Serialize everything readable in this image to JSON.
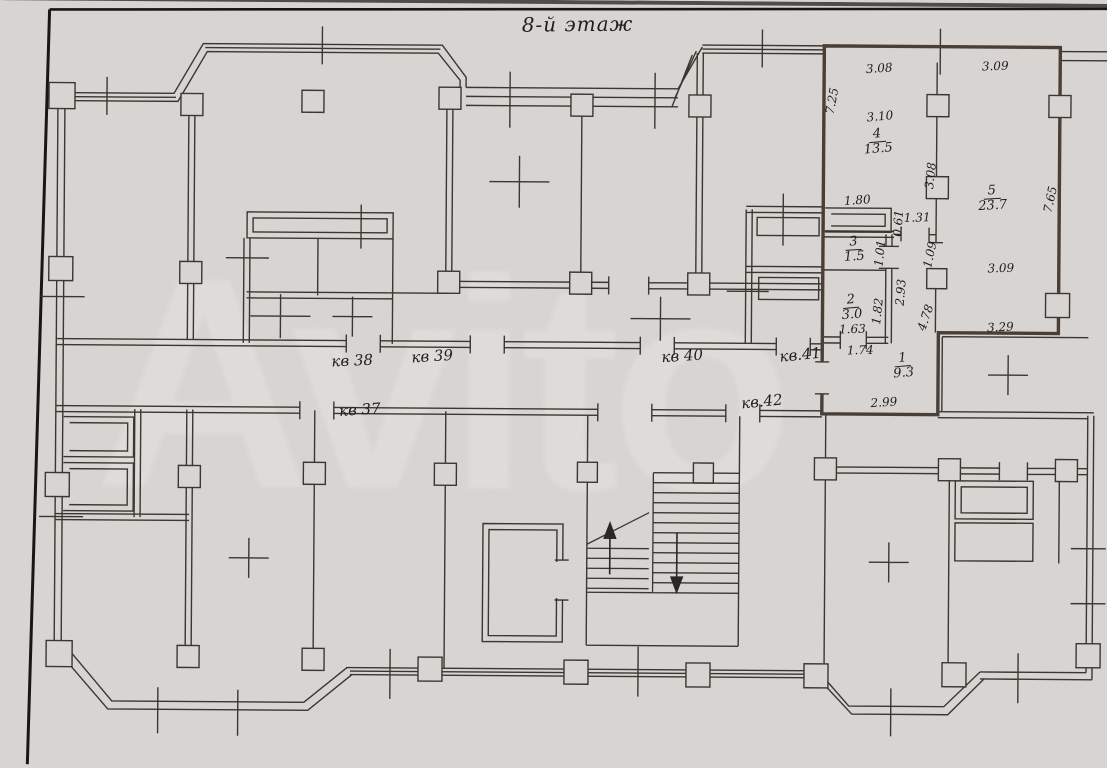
{
  "title": "8-й этаж",
  "watermark": "Avito",
  "apartments": [
    {
      "label": "кв 38"
    },
    {
      "label": "кв 39"
    },
    {
      "label": "кв 40"
    },
    {
      "label": "кв.41"
    },
    {
      "label": "кв 37"
    },
    {
      "label": "кв.42"
    }
  ],
  "flat": {
    "accent_color": "#4a3e35",
    "rooms": [
      {
        "number": "1",
        "area": "9.3"
      },
      {
        "number": "2",
        "area": "3.0"
      },
      {
        "number": "3",
        "area": "1.5"
      },
      {
        "number": "4",
        "area": "13.5"
      },
      {
        "number": "5",
        "area": "23.7"
      }
    ],
    "dims": {
      "room4_top_width": "3.08",
      "room5_top_width": "3.09",
      "left_height": "7.25",
      "room4_inner_width": "3.10",
      "rooms45_divider_height": "3.08",
      "room5_right_height": "7.65",
      "closet_width": "1.80",
      "closet_depth": "0.61",
      "room4_door_width": "1.31",
      "room3_inner_height": "1.01",
      "hall_top_height": "1.09",
      "rooms23_height": "2.93",
      "room5_mid_width": "3.09",
      "room2_height": "1.82",
      "room2_width": "1.63",
      "hall_height": "4.78",
      "hall_width_mid": "1.74",
      "room5_bottom_width": "3.29",
      "room1_width": "2.99"
    }
  }
}
